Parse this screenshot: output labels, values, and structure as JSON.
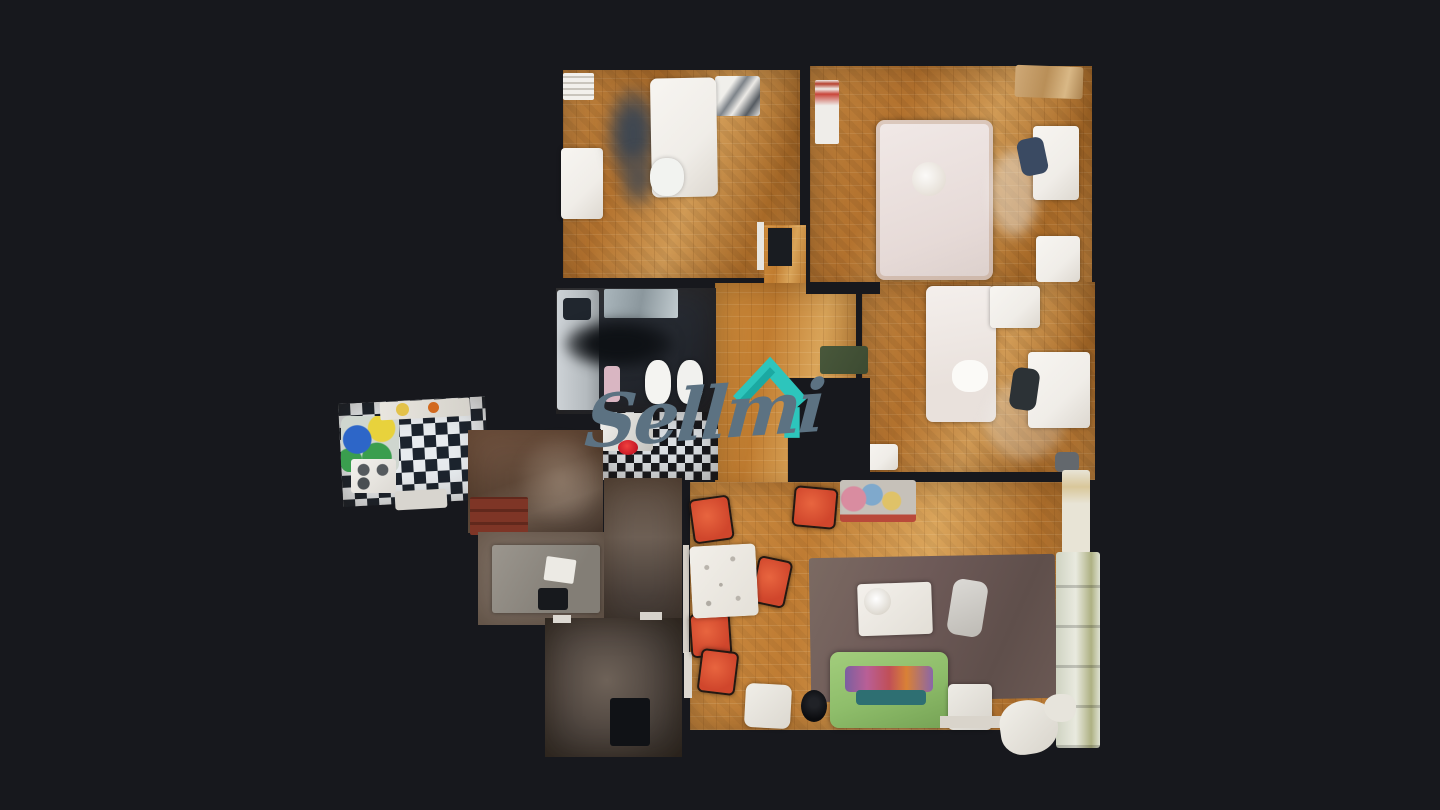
{
  "watermark": {
    "text": "Sellmi"
  },
  "palette": {
    "background": "#17181d",
    "brand_teal": "#2dc5bc",
    "brand_teal_dark": "#1ba9a2",
    "brand_slate": "#5c7282",
    "parquet": "#c08440",
    "parquet_deep": "#a86a28",
    "parquet_light": "#d09a55",
    "hall_floor": "#6a564a",
    "dark_floor": "#46403a",
    "rug": "#6e5a58",
    "sofa_green": "#8fbe6b",
    "chair_red": "#d0462c",
    "furniture_white": "#f0ede8",
    "checker_dark": "#1c242e",
    "checker_light": "#dde2e6",
    "bath_floor": "#262a31"
  }
}
